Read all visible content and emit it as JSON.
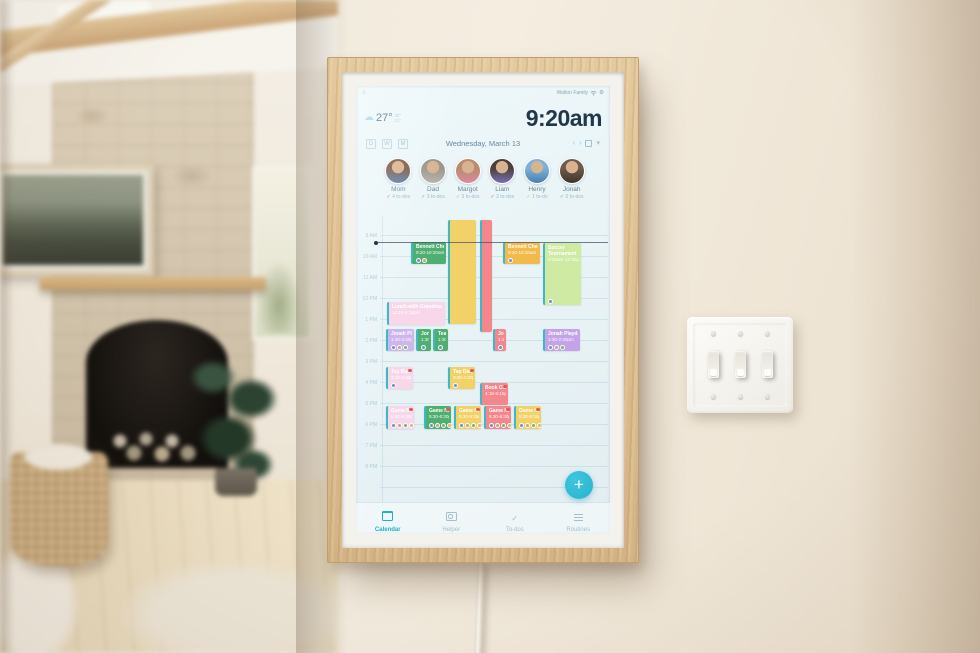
{
  "device": {
    "status": {
      "account": "Walton Family",
      "menu_glyph": "≡",
      "gear_glyph": "⚙"
    },
    "weather": {
      "icon": "cloud",
      "temp": "27°",
      "high": "32°",
      "low": "21°"
    },
    "clock": "9:20am",
    "header": {
      "date": "Wednesday, March 13",
      "view_buttons": [
        {
          "label": "D"
        },
        {
          "label": "W"
        },
        {
          "label": "M"
        }
      ],
      "actions": [
        {
          "name": "prev-day",
          "glyph": "‹"
        },
        {
          "name": "next-day",
          "glyph": "›"
        },
        {
          "name": "today",
          "glyph": "box"
        },
        {
          "name": "more",
          "glyph": "▾"
        }
      ]
    },
    "people": [
      {
        "name": "Mom",
        "todos": "4 to-dos",
        "check": "✓",
        "check_color": "#e2654f",
        "colors": [
          "#7b5a44",
          "#5b7fae"
        ]
      },
      {
        "name": "Dad",
        "todos": "3 to-dos",
        "check": "✓",
        "check_color": "#45b97e",
        "colors": [
          "#9a958c",
          "#b7b2a8"
        ]
      },
      {
        "name": "Margot",
        "todos": "3 to-dos",
        "check": "✓",
        "check_color": "#f0a94e",
        "colors": [
          "#b98c6e",
          "#d98aa0"
        ]
      },
      {
        "name": "Liam",
        "todos": "2 to-dos",
        "check": "✓",
        "check_color": "#e2654f",
        "colors": [
          "#4a4038",
          "#7a6fb3"
        ]
      },
      {
        "name": "Henry",
        "todos": "1 to-do",
        "check": "✓",
        "check_color": "#f0a94e",
        "colors": [
          "#7ab2dc",
          "#4a7fae"
        ]
      },
      {
        "name": "Jonah",
        "todos": "0 to-dos",
        "check": "✓",
        "check_color": "#45b97e",
        "colors": [
          "#6e5b4c",
          "#3d342c"
        ]
      }
    ],
    "event_colors": {
      "yellow": "#f2d268",
      "salmon": "#f5878c",
      "green": "#4fae70",
      "amber": "#f2b94b",
      "lightgreen": "#cfeaa2",
      "pink": "#f7d7e9",
      "lavender": "#cdb6ec",
      "purple": "#c5a3e8",
      "accent_border": "#3fb8c4"
    },
    "schedule": {
      "time_labels": [
        "9 AM",
        "10 AM",
        "11 AM",
        "12 PM",
        "1 PM",
        "2 PM",
        "3 PM",
        "4 PM",
        "5 PM",
        "6 PM",
        "7 PM",
        "8 PM"
      ],
      "hour_height": 21,
      "first_line_y": 19,
      "now_line_y": 26,
      "events": [
        {
          "title": "",
          "time": "",
          "color": "yellow",
          "x": 92,
          "y": 4,
          "w": 28,
          "h": 104,
          "avatars": 0,
          "badge": false
        },
        {
          "title": "",
          "time": "",
          "color": "salmon",
          "x": 124,
          "y": 4,
          "w": 12,
          "h": 112,
          "avatars": 0,
          "badge": false
        },
        {
          "title": "Bennett Checkup",
          "time": "9:20-10:20am",
          "color": "green",
          "x": 55,
          "y": 26,
          "w": 35,
          "h": 22,
          "avatars": 2,
          "badge": false
        },
        {
          "title": "Bennett Checkup",
          "time": "9:20-10:20am",
          "color": "amber",
          "x": 147,
          "y": 26,
          "w": 37,
          "h": 22,
          "avatars": 1,
          "badge": false
        },
        {
          "title": "Soccer Tournament",
          "time": "9:30am-12:30pm",
          "color": "lightgreen",
          "x": 187,
          "y": 27,
          "w": 38,
          "h": 62,
          "avatars": 1,
          "badge": false
        },
        {
          "title": "Lunch with Grandma",
          "time": "12:15-1:15pm",
          "color": "pink",
          "x": 31,
          "y": 86,
          "w": 58,
          "h": 23,
          "avatars": 0,
          "badge": false
        },
        {
          "title": "Jonah Playdate",
          "time": "1:30-2:30pm",
          "color": "lavender",
          "x": 30,
          "y": 113,
          "w": 28,
          "h": 22,
          "avatars": 3,
          "badge": false
        },
        {
          "title": "Jonah Playdate",
          "time": "1:30pm",
          "color": "green",
          "x": 60,
          "y": 113,
          "w": 15,
          "h": 22,
          "avatars": 1,
          "badge": false
        },
        {
          "title": "Team Meeting",
          "time": "1:30pm",
          "color": "green",
          "x": 77,
          "y": 113,
          "w": 15,
          "h": 22,
          "avatars": 1,
          "badge": false
        },
        {
          "title": "Jonah Playdate",
          "time": "1:30pm",
          "color": "salmon",
          "x": 137,
          "y": 113,
          "w": 13,
          "h": 22,
          "avatars": 1,
          "badge": false
        },
        {
          "title": "Jonah Playdate",
          "time": "1:30-2:30pm",
          "color": "purple",
          "x": 187,
          "y": 113,
          "w": 37,
          "h": 22,
          "avatars": 3,
          "badge": false
        },
        {
          "title": "Tap Dance",
          "time": "3:30-4:30pm",
          "color": "pink",
          "x": 30,
          "y": 151,
          "w": 27,
          "h": 22,
          "avatars": 1,
          "badge": true
        },
        {
          "title": "Tap Dance",
          "time": "3:30-4:30pm",
          "color": "yellow",
          "x": 92,
          "y": 151,
          "w": 27,
          "h": 22,
          "avatars": 1,
          "badge": true
        },
        {
          "title": "Book Club",
          "time": "4:15-5:15pm",
          "color": "salmon",
          "x": 124,
          "y": 167,
          "w": 28,
          "h": 22,
          "avatars": 0,
          "badge": true
        },
        {
          "title": "Game Night",
          "time": "5:30-6:30pm",
          "color": "pink",
          "x": 30,
          "y": 190,
          "w": 28,
          "h": 23,
          "avatars": 4,
          "badge": true
        },
        {
          "title": "Game Night",
          "time": "5:30-6:30pm",
          "color": "green",
          "x": 68,
          "y": 190,
          "w": 27,
          "h": 23,
          "avatars": 4,
          "badge": true
        },
        {
          "title": "Game Night",
          "time": "5:30-6:30pm",
          "color": "yellow",
          "x": 98,
          "y": 190,
          "w": 27,
          "h": 23,
          "avatars": 4,
          "badge": true
        },
        {
          "title": "Game Night",
          "time": "5:30-6:30pm",
          "color": "salmon",
          "x": 128,
          "y": 190,
          "w": 27,
          "h": 23,
          "avatars": 4,
          "badge": true
        },
        {
          "title": "Game Night",
          "time": "5:30-6:30pm",
          "color": "yellow",
          "x": 158,
          "y": 190,
          "w": 27,
          "h": 23,
          "avatars": 4,
          "badge": true
        }
      ]
    },
    "nav": {
      "items": [
        {
          "label": "Calendar",
          "icon": "calendar",
          "active": true
        },
        {
          "label": "Helper",
          "icon": "helper",
          "active": false
        },
        {
          "label": "To-dos",
          "icon": "todos",
          "active": false
        },
        {
          "label": "Routines",
          "icon": "routines",
          "active": false
        }
      ]
    },
    "fab": "+"
  },
  "scene": {
    "frame_color": "#dcc094",
    "wall_color": "#efe8db",
    "accent": "#27b2ce"
  }
}
